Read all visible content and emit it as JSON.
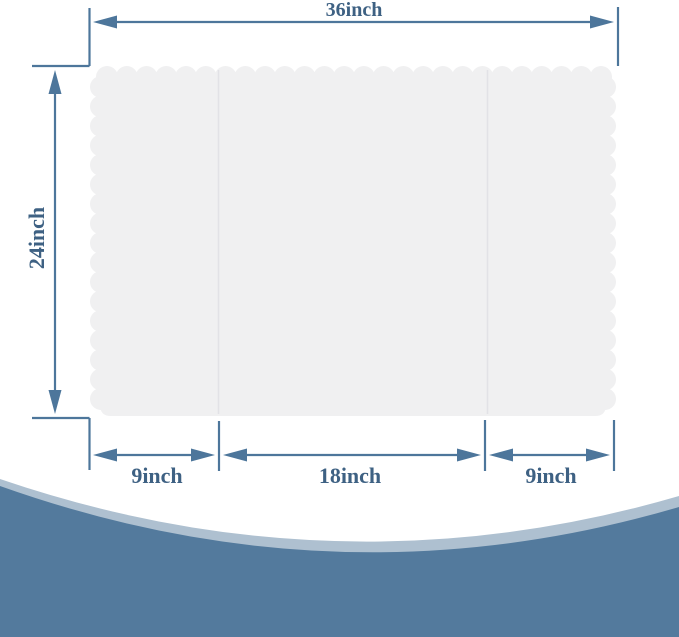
{
  "diagram": {
    "description": "Tri-fold scalloped-edge display board dimension diagram",
    "dimensions": {
      "total_width_label": "36inch",
      "height_label": "24inch",
      "bottom_panels": [
        {
          "label": "9inch"
        },
        {
          "label": "18inch"
        },
        {
          "label": "9inch"
        }
      ]
    },
    "colors": {
      "dimension_line": "#4d769b",
      "label_text": "#3e6183",
      "board_fill": "#f0f0f1",
      "fold_line": "#e2e2e6",
      "wave_dark_blue": "#537a9d",
      "wave_light_blue": "#aec0d0",
      "background": "#ffffff"
    }
  }
}
